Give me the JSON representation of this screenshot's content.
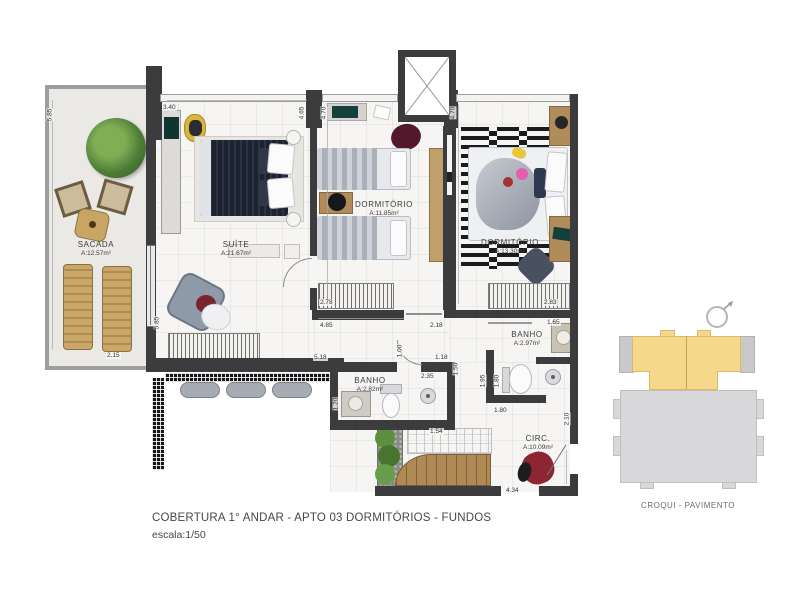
{
  "title1": "COBERTURA 1° ANDAR - APTO  03  DORMITÓRIOS - FUNDOS",
  "title2": "escala:1/50",
  "rooms": {
    "sacada": {
      "name": "SACADA",
      "area": "A:12.57m²"
    },
    "suite": {
      "name": "SUÍTE",
      "area": "A:21.67m²"
    },
    "dorm1": {
      "name": "DORMITÓRIO",
      "area": "A:11.85m²"
    },
    "dorm2": {
      "name": "DORMITÓRIO",
      "area": "A:13.30m²"
    },
    "banho1": {
      "name": "BANHO",
      "area": "A:2.82m²"
    },
    "banho2": {
      "name": "BANHO",
      "area": "A:2.97m²"
    },
    "circ": {
      "name": "CIRC.",
      "area": "A:10.09m²"
    }
  },
  "dims": [
    "5.85",
    "2.15",
    "3.40",
    "4.65",
    "4.70",
    "4.70",
    "2.78",
    "4.85",
    "2.18",
    "2.83",
    "1.65",
    "5.85",
    "5.18",
    "1.00",
    "1.18",
    "2.35",
    "1.50",
    "1.20",
    "1.95",
    "1.80",
    "1.80",
    "2.10",
    "1.54",
    "4.34"
  ],
  "croqui": {
    "label": "CROQUI - PAVIMENTO"
  },
  "colors": {
    "wall": "#3c3c3e",
    "highlight_unit": "#f5d88b",
    "building_gray": "#d4d4d6",
    "wood": "#b08a55",
    "accent_red": "#8c2633",
    "bed_dark": "#222a38"
  }
}
